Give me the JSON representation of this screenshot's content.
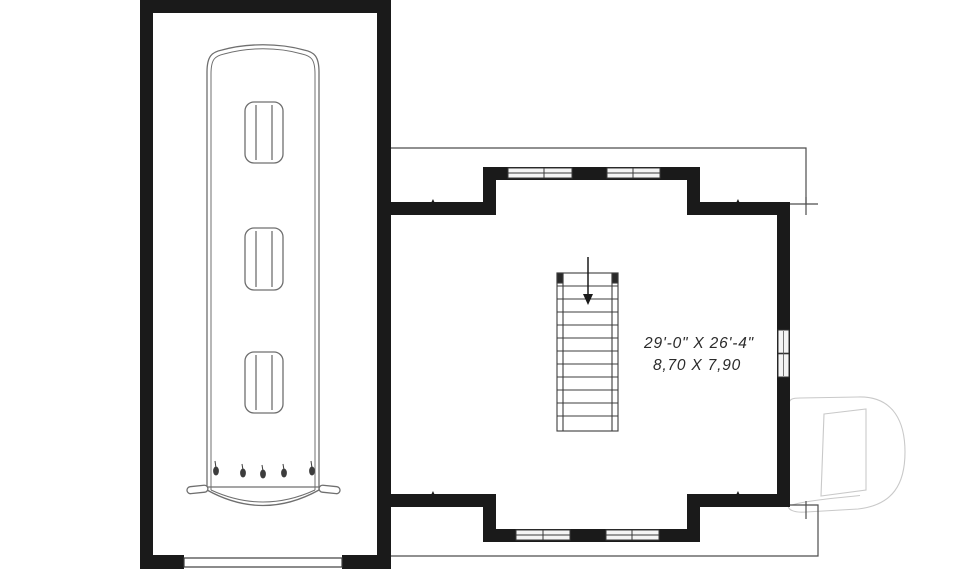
{
  "plan": {
    "type": "floor-plan",
    "room": {
      "dimensions_imperial": "29'-0\" X 26'-4\"",
      "dimensions_metric": "8,70 X 7,90"
    },
    "features": {
      "staircase_treads": 11,
      "stair_direction": "down-arrow",
      "garage_contents": "boat-top-view",
      "boat_hatches": 3,
      "north_window_units": 4,
      "south_window_units": 4,
      "east_window_units": 1,
      "garage_door": "south-opening"
    },
    "watermark": "D-logo"
  },
  "colors": {
    "wall": "#1a1a1a",
    "thin_line": "#4d4d4d",
    "boat_line": "#6f6f6f",
    "stair_line": "#3c3c3c",
    "window_fill": "#f4f4f4",
    "logo_line": "#c9c9c9",
    "text": "#2b2b2b",
    "background": "#ffffff"
  }
}
